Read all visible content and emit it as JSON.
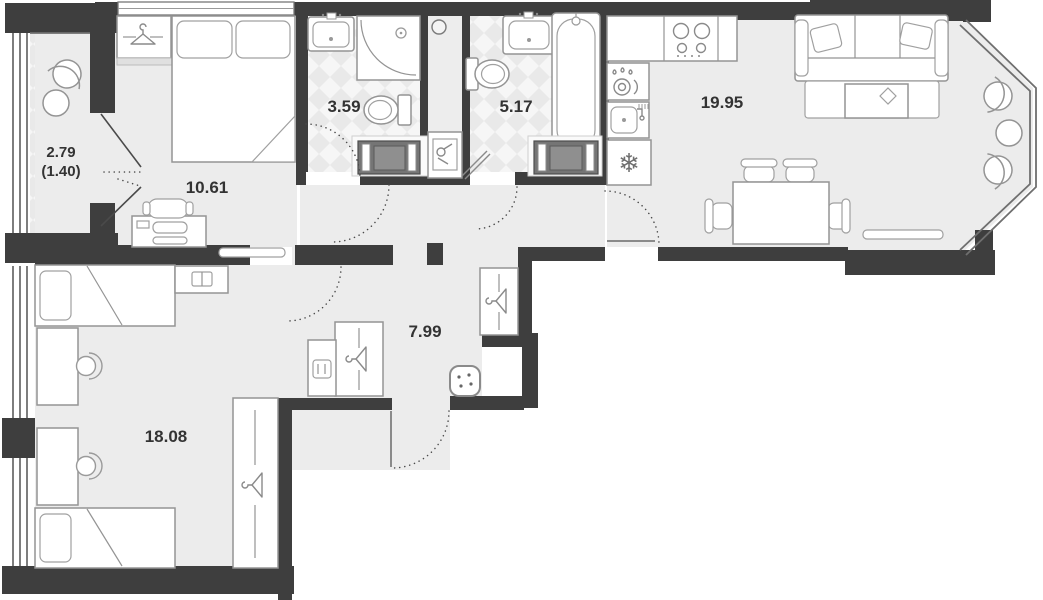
{
  "plan": {
    "title": "apartment-floor-plan",
    "rooms": {
      "balcony": {
        "name": "balcony",
        "area": "2.79",
        "area_coef": "(1.40)"
      },
      "bedroom": {
        "name": "bedroom",
        "area": "10.61"
      },
      "bathroom_small": {
        "name": "shower-room",
        "area": "3.59"
      },
      "bathroom_large": {
        "name": "bathroom",
        "area": "5.17"
      },
      "kitchen_living": {
        "name": "kitchen-living",
        "area": "19.95"
      },
      "hallway": {
        "name": "hallway",
        "area": "7.99"
      },
      "bedroom_second": {
        "name": "children-bedroom",
        "area": "18.08"
      }
    },
    "icons": {
      "fridge_snowflake": "❄"
    },
    "colors": {
      "wall": "#3e3e3e",
      "floor": "#ececec",
      "checker_base": "#f6f6f6",
      "checker_diamond": "#e7e7e7",
      "appliance_dark": "#757575"
    }
  }
}
